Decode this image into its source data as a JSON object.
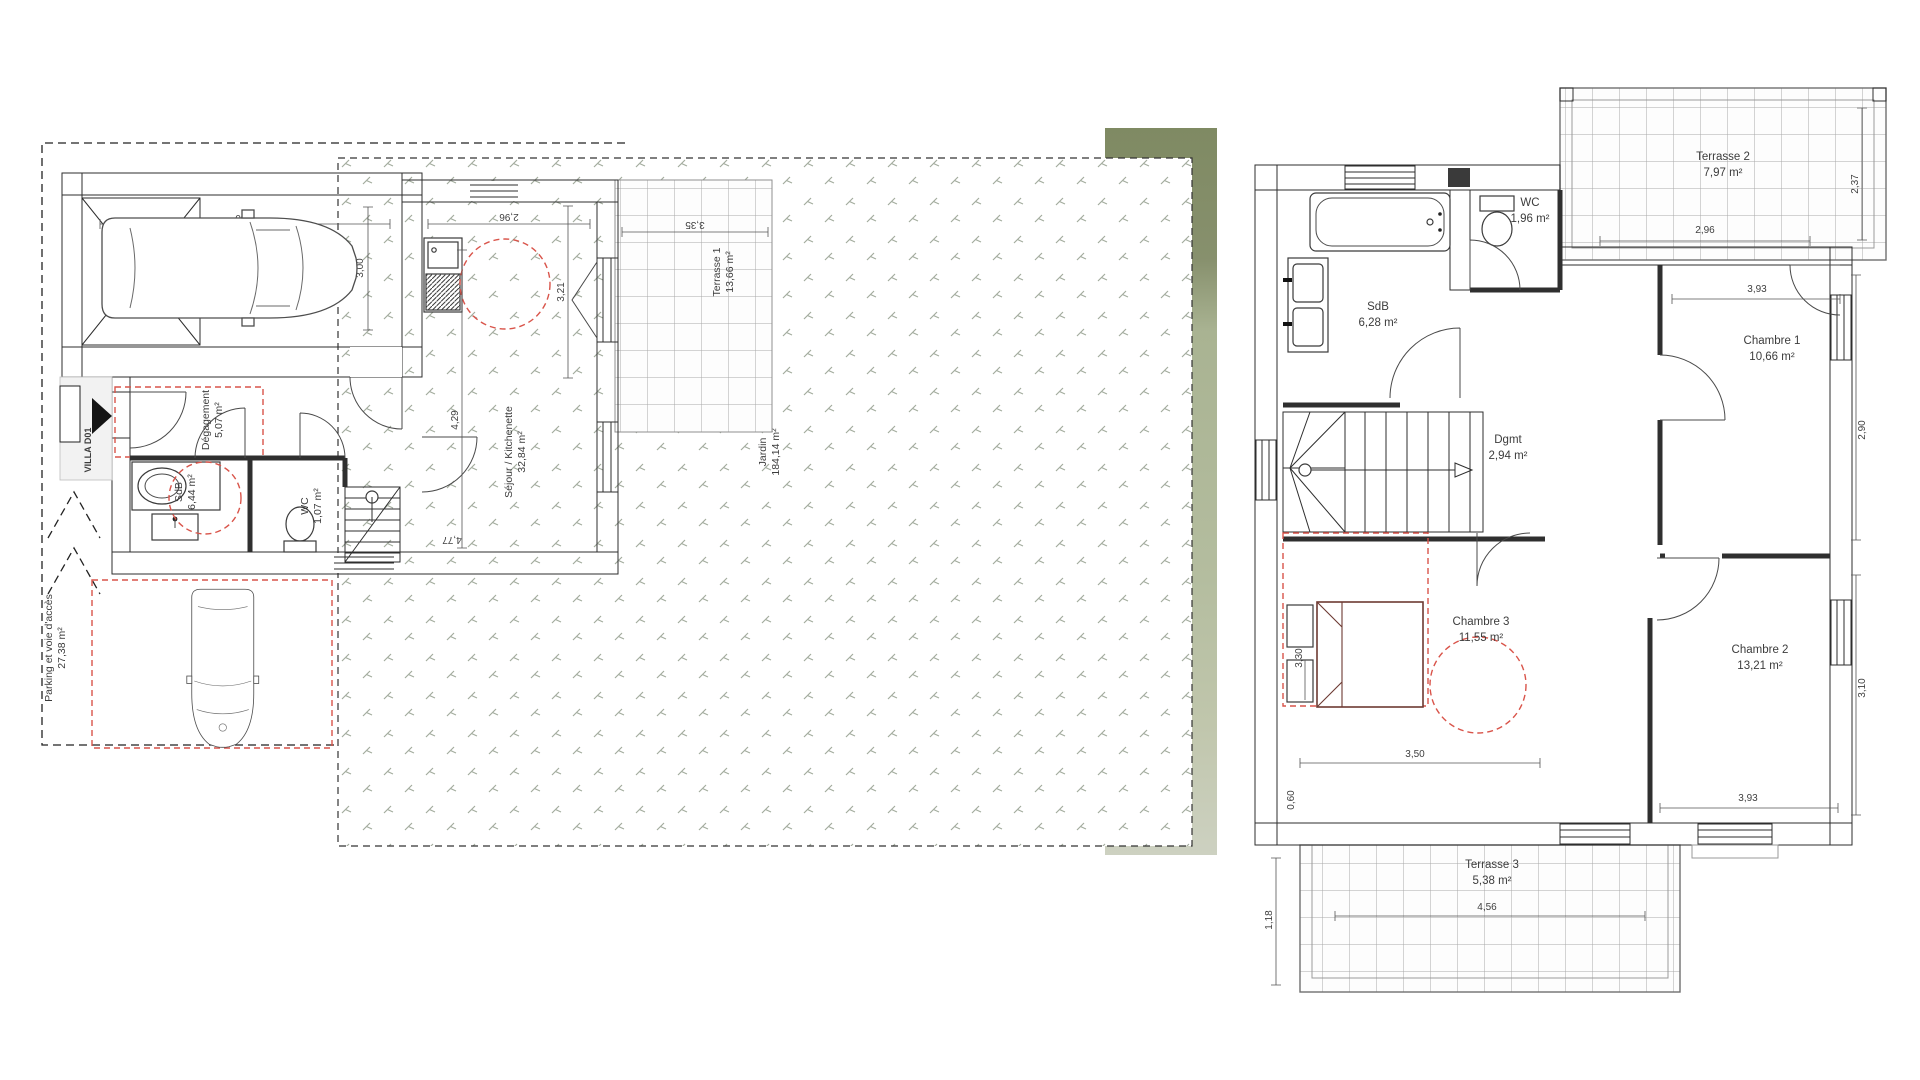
{
  "ground_floor": {
    "villa_tag": "VILLA D01",
    "garage": {
      "name": "Garage G28",
      "area": "16,50 m²"
    },
    "degagement": {
      "name": "Dégagement",
      "area": "5,07 m²"
    },
    "sdb": {
      "name": "SdB",
      "area": "6,44 m²"
    },
    "wc": {
      "name": "WC",
      "area": "1,07 m²"
    },
    "sejour": {
      "name": "Séjour / Kitchenette",
      "area": "32,84 m²"
    },
    "terrasse1": {
      "name": "Terrasse 1",
      "area": "13,66 m²"
    },
    "jardin": {
      "name": "Jardin",
      "area": "184,14 m²"
    },
    "parking": {
      "name": "Parking et voie d'accès",
      "area": "27,38 m²"
    },
    "dims": {
      "garage_width": "5,50",
      "garage_depth": "3,00",
      "sejour_width": "2,96",
      "sejour_depth": "3,21",
      "terrasse_width": "3,35",
      "sejour_length": "4,29",
      "sejour_bottom": "4,77"
    }
  },
  "upper_floor": {
    "sdb": {
      "name": "SdB",
      "area": "6,28 m²"
    },
    "wc": {
      "name": "WC",
      "area": "1,96 m²"
    },
    "terrasse2": {
      "name": "Terrasse 2",
      "area": "7,97 m²"
    },
    "chambre1": {
      "name": "Chambre 1",
      "area": "10,66 m²"
    },
    "dgmt": {
      "name": "Dgmt",
      "area": "2,94 m²"
    },
    "chambre2": {
      "name": "Chambre 2",
      "area": "13,21 m²"
    },
    "chambre3": {
      "name": "Chambre 3",
      "area": "11,55 m²"
    },
    "terrasse3": {
      "name": "Terrasse 3",
      "area": "5,38 m²"
    },
    "dims": {
      "terrasse2_depth": "2,37",
      "terrasse2_width": "2,96",
      "chambre1_width": "3,93",
      "chambre1_depth": "2,90",
      "chambre2_depth": "3,10",
      "chambre2_width": "3,93",
      "chambre3_width": "3,50",
      "chambre3_bed": "3,30",
      "wall_segment": "0,60",
      "terrasse3_width": "4,56",
      "terrasse3_depth": "1,18"
    }
  },
  "colors": {
    "red_dashed": "#d9544a",
    "green_band_dark": "#87906d",
    "green_band_light": "#b4bd9f",
    "wall_speckle": "#ededed"
  }
}
